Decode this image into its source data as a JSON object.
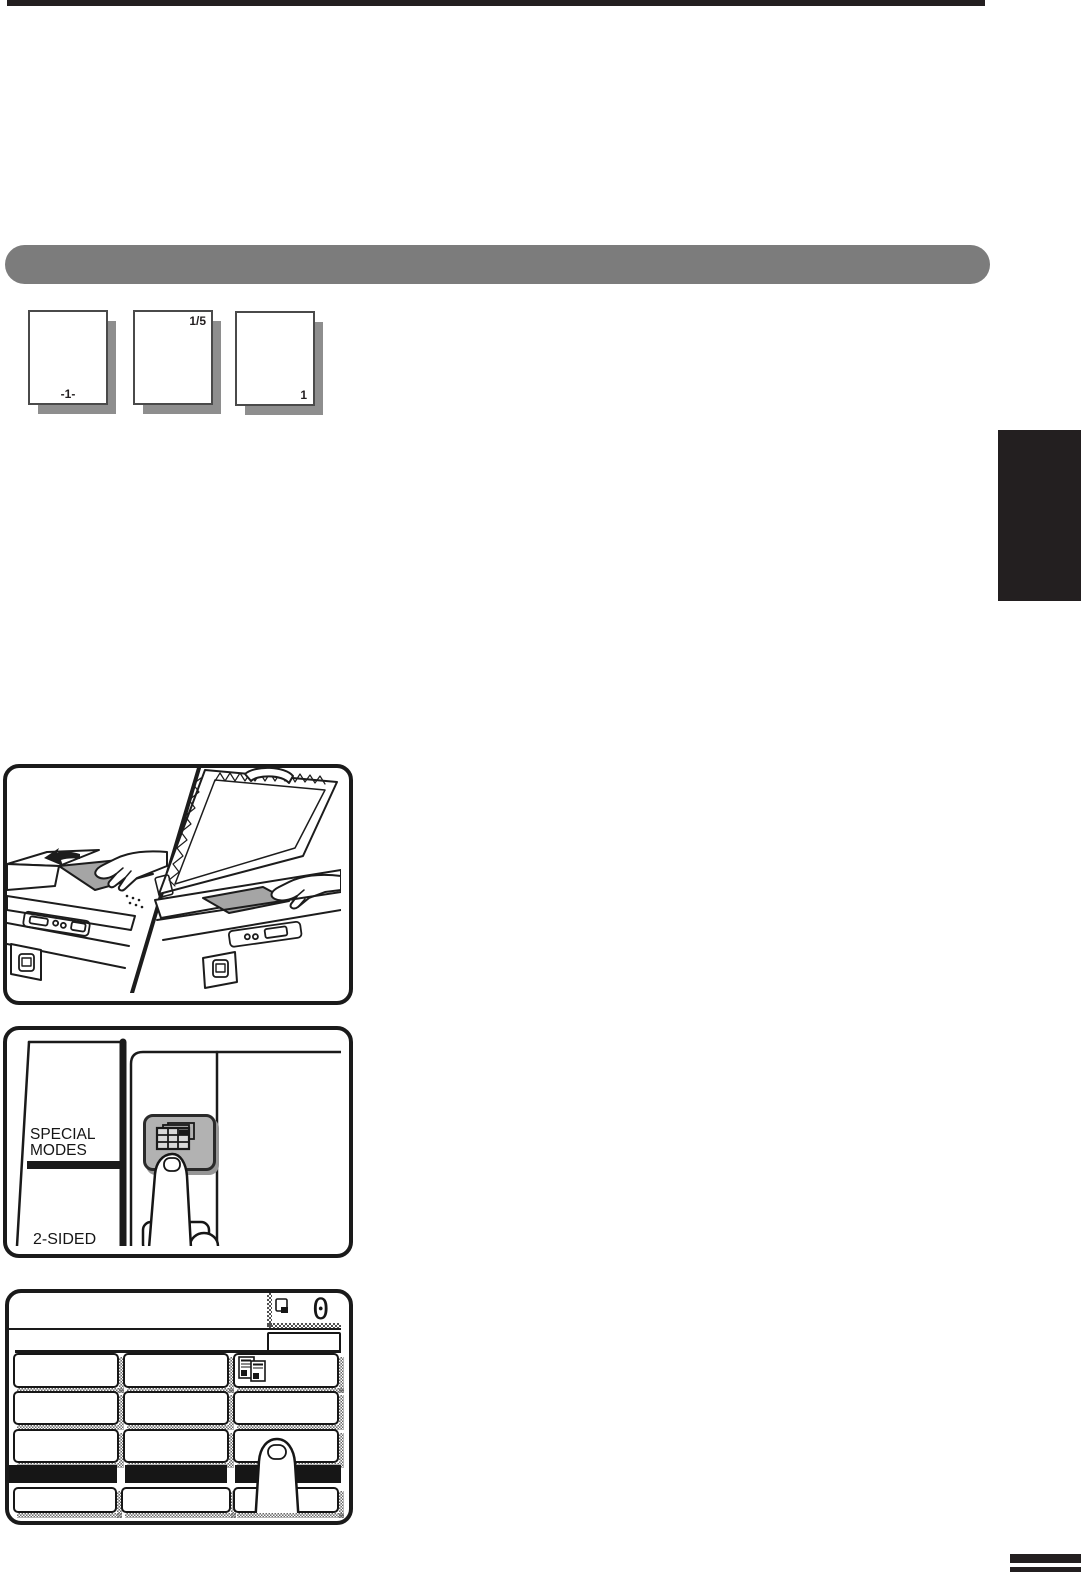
{
  "colors": {
    "ink": "#231f20",
    "section_bar": "#7c7c7c",
    "key_gray": "#b2b2b2",
    "document_gray": "#a5a5a5",
    "shadow_gray": "#8e8e8e"
  },
  "page_icons": [
    {
      "label": "-1-",
      "label_position": "bottom-center"
    },
    {
      "label": "1/5",
      "label_position": "top-right"
    },
    {
      "label": "1",
      "label_position": "bottom-right"
    }
  ],
  "special_modes_panel": {
    "title_line1": "SPECIAL",
    "title_line2": "MODES",
    "bottom_label": "2-SIDED",
    "key_icon": "special-modes-key-icon"
  },
  "touch_screen": {
    "copy_count": "0",
    "icons": [
      "copy-mode-icon",
      "multi-shot-icon"
    ]
  }
}
